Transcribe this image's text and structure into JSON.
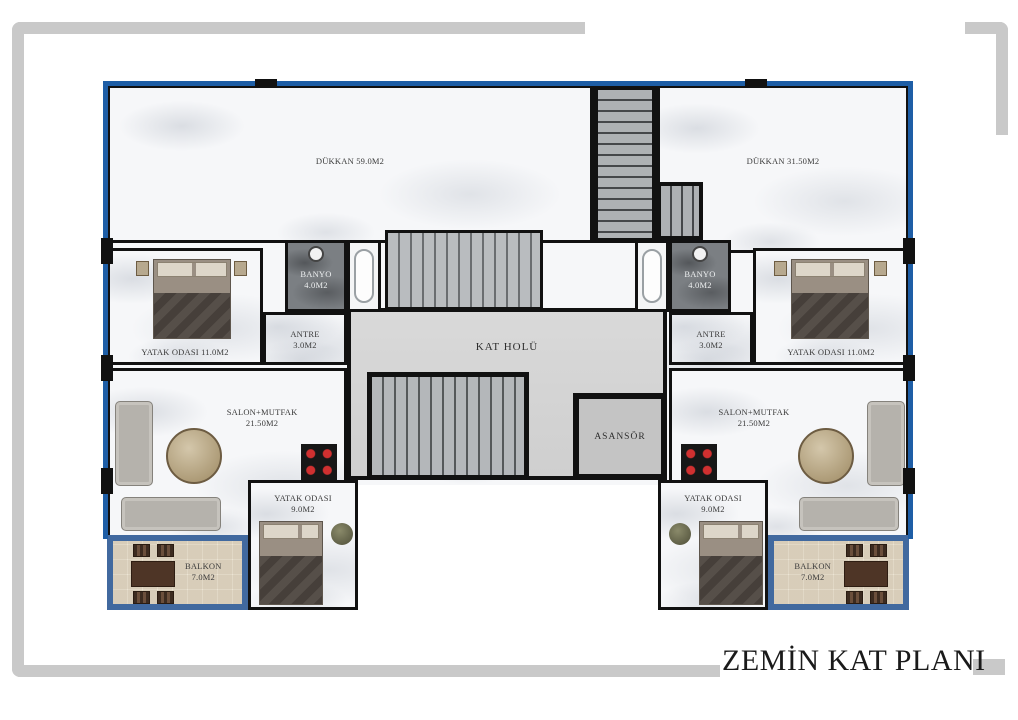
{
  "title": "ZEMİN KAT PLANI",
  "colors": {
    "frame_gray": "#c9c9c9",
    "outline_blue": "#1e5ea6",
    "balcony_wall_blue": "#41699f",
    "wall_black": "#111111",
    "hall_floor_gray": "#d6d6d6",
    "banyo_dark_marble": "#7b7f83"
  },
  "rooms": {
    "dukkan_left": {
      "label": "DÜKKAN 59.0M2"
    },
    "dukkan_right": {
      "label": "DÜKKAN 31.50M2"
    },
    "yatak11_left": {
      "label": "YATAK ODASI 11.0M2"
    },
    "yatak11_right": {
      "label": "YATAK ODASI 11.0M2"
    },
    "banyo_left": {
      "name": "BANYO",
      "area": "4.0M2"
    },
    "banyo_right": {
      "name": "BANYO",
      "area": "4.0M2"
    },
    "antre_left": {
      "name": "ANTRE",
      "area": "3.0M2"
    },
    "antre_right": {
      "name": "ANTRE",
      "area": "3.0M2"
    },
    "kat_holu": {
      "label": "KAT HOLÜ"
    },
    "asansor": {
      "label": "ASANSÖR"
    },
    "salon_left": {
      "name": "SALON+MUTFAK",
      "area": "21.50M2"
    },
    "salon_right": {
      "name": "SALON+MUTFAK",
      "area": "21.50M2"
    },
    "yatak9_left": {
      "name": "YATAK ODASI",
      "area": "9.0M2"
    },
    "yatak9_right": {
      "name": "YATAK ODASI",
      "area": "9.0M2"
    },
    "balkon_left": {
      "name": "BALKON",
      "area": "7.0M2"
    },
    "balkon_right": {
      "name": "BALKON",
      "area": "7.0M2"
    }
  }
}
